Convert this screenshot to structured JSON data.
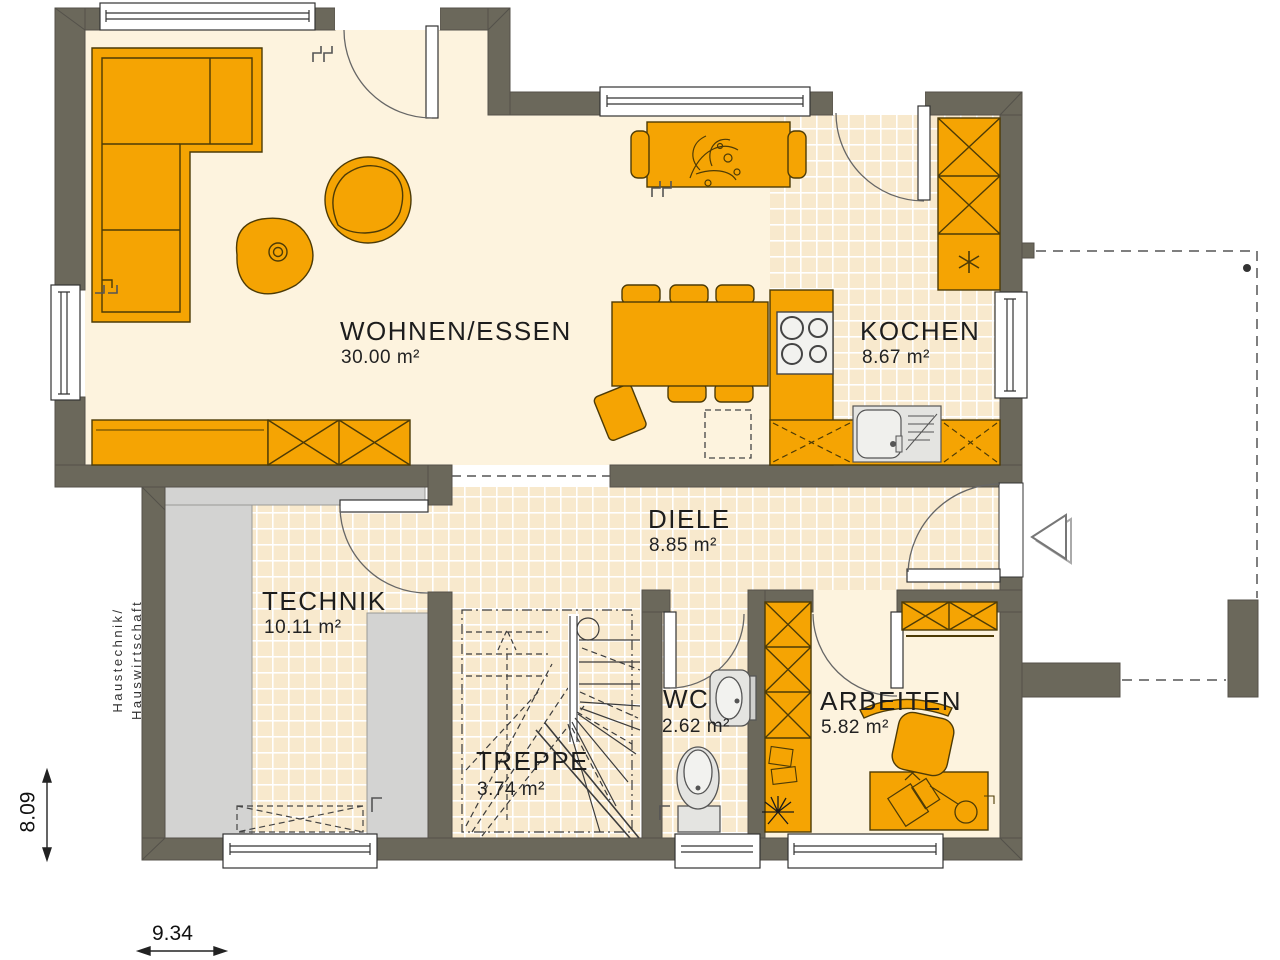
{
  "plan": {
    "title": "Floor plan ground floor",
    "rooms": [
      {
        "id": "wohnen",
        "name": "WOHNEN/ESSEN",
        "area": "30.00 m²"
      },
      {
        "id": "kochen",
        "name": "KOCHEN",
        "area": "8.67 m²"
      },
      {
        "id": "diele",
        "name": "DIELE",
        "area": "8.85 m²"
      },
      {
        "id": "technik",
        "name": "TECHNIK",
        "area": "10.11 m²"
      },
      {
        "id": "treppe",
        "name": "TREPPE",
        "area": "3.74 m²"
      },
      {
        "id": "wc",
        "name": "WC",
        "area": "2.62 m²"
      },
      {
        "id": "arbeiten",
        "name": "ARBEITEN",
        "area": "5.82 m²"
      }
    ],
    "annotation": {
      "line1": "Haustechnik/",
      "line2": "Hauswirtschaft"
    },
    "dimensions": {
      "height_label": "8.09",
      "width_label": "9.34"
    },
    "colors": {
      "wall": "#6b685b",
      "furniture_orange": "#f5a403",
      "floor_cream": "#fdf3de",
      "tile_cream": "#f8e9cd",
      "utility_gray": "#d3d3d2",
      "fixture_gray": "#e4e4e1",
      "outline_dark": "#4d3b06"
    }
  }
}
